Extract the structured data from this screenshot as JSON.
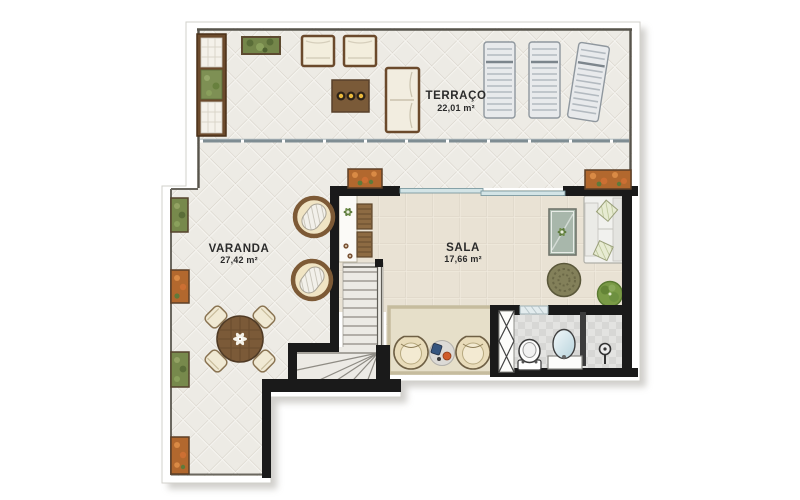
{
  "plan": {
    "title": "penthouse-upper-floor-plan",
    "rooms": [
      {
        "id": "terraco",
        "name": "TERRAÇO",
        "area": "22,01 m²"
      },
      {
        "id": "varanda",
        "name": "VARANDA",
        "area": "27,42 m²"
      },
      {
        "id": "sala",
        "name": "SALA",
        "area": "17,66 m²"
      }
    ],
    "furniture": {
      "terraco": [
        "storage-bench-unit",
        "planter-box",
        "armchair",
        "armchair",
        "coffee-table-with-candles",
        "two-seat-sofa",
        "sun-lounger",
        "sun-lounger",
        "sun-lounger",
        "glass-railing"
      ],
      "varanda": [
        "wall-planter-green",
        "wall-planter-orange",
        "wall-planter-green",
        "wall-planter-orange",
        "egg-chair",
        "egg-chair",
        "round-dining-table",
        "dining-chairs"
      ],
      "sala": [
        "console-with-stools",
        "glass-side-table",
        "l-shaped-sofa",
        "rattan-pouf",
        "potted-plant",
        "area-rug",
        "tulip-armchair",
        "tulip-armchair",
        "round-side-table",
        "staircase",
        "sliding-glass-door"
      ],
      "bathroom": [
        "folding-door",
        "toilet",
        "vanity-sink",
        "shower-head",
        "window"
      ]
    },
    "colors": {
      "wall": "#1a1a1a",
      "terrace_floor": "#edebe5",
      "sala_floor": "#e9e2d4",
      "bath_floor": "#e3e3e1",
      "glass": "#cfe3e6",
      "planter_orange": "#b2682e",
      "planter_green": "#74864a",
      "wood": "#6b4a2c",
      "background": "#ffffff"
    }
  }
}
